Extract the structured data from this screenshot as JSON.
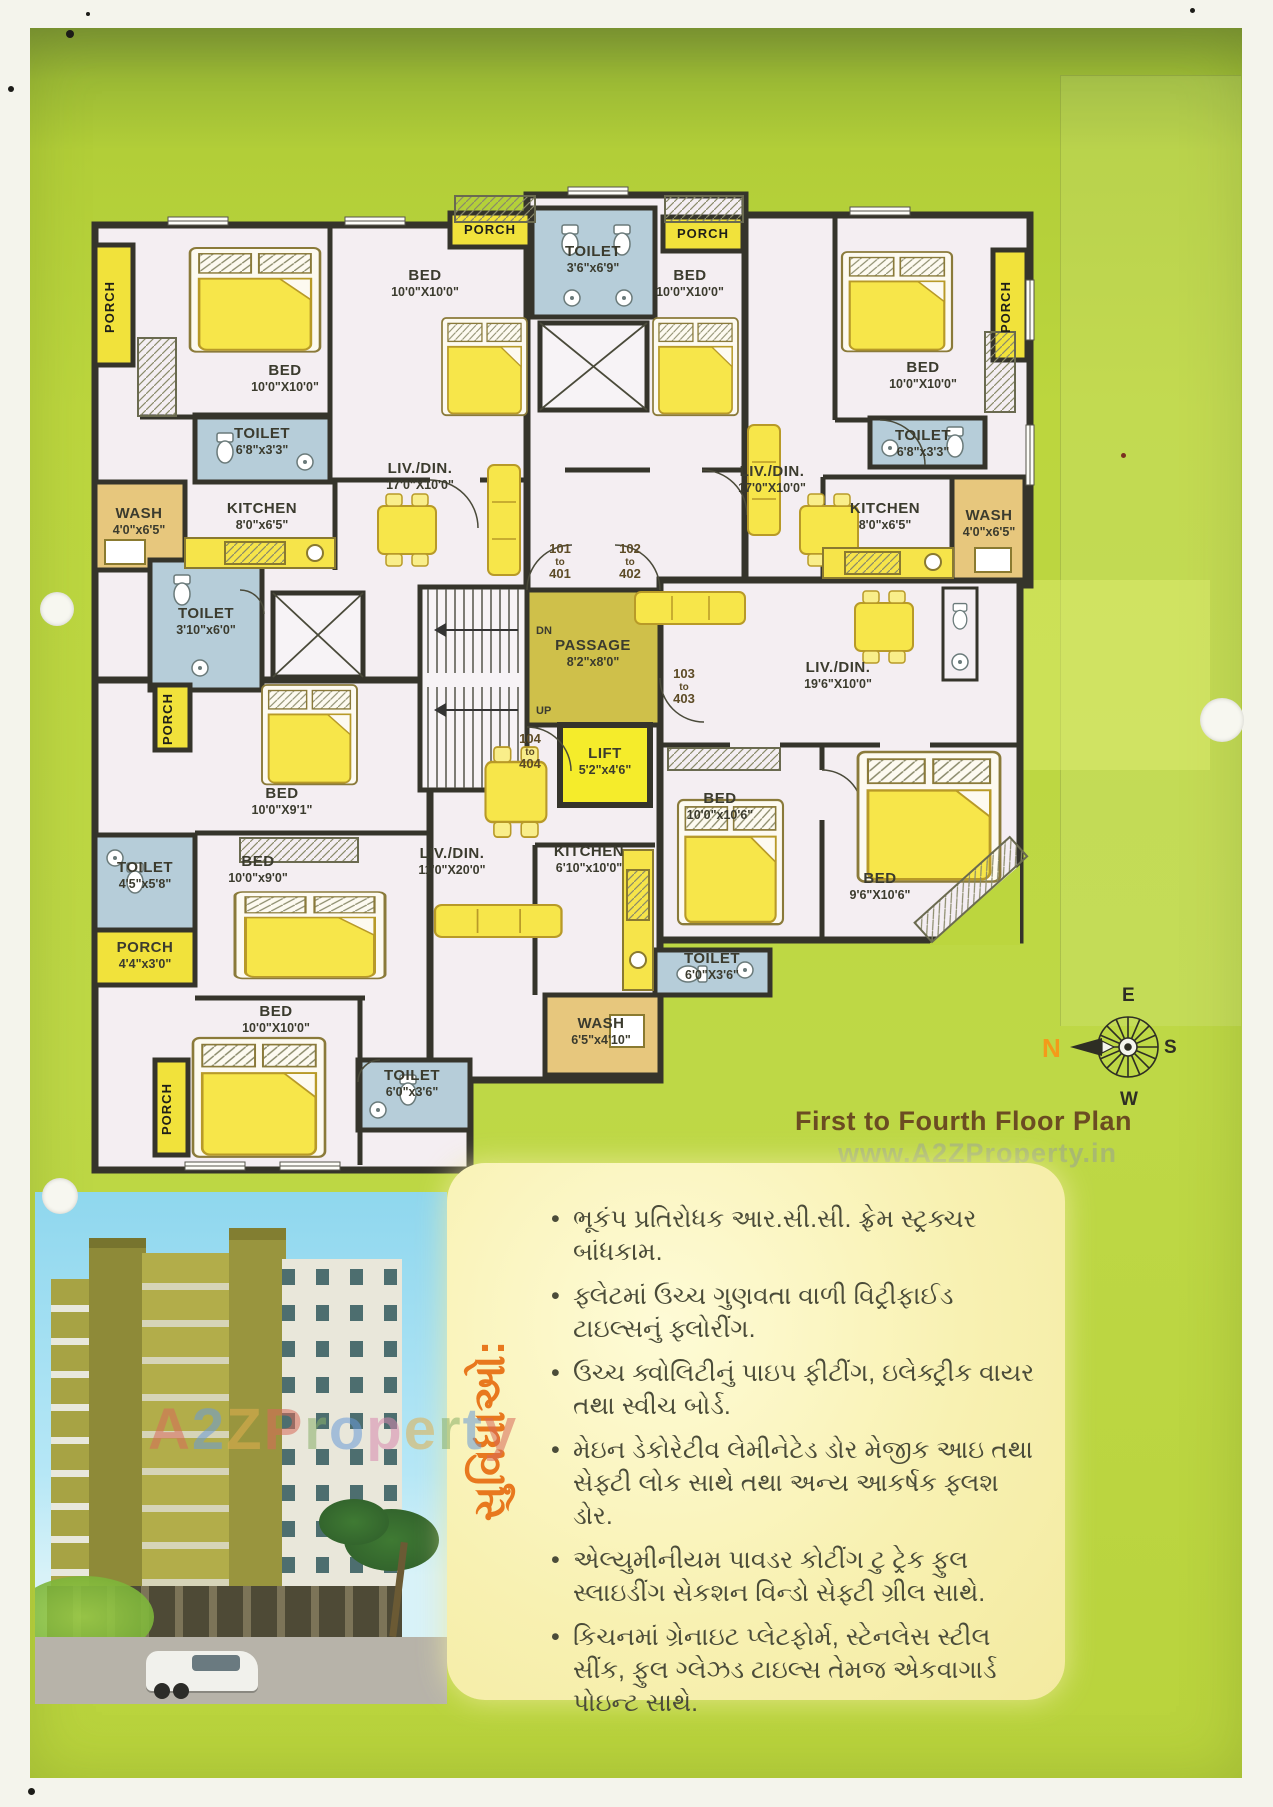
{
  "page": {
    "title": "First to Fourth Floor Plan",
    "watermark_small": "www.A2ZProperty.in",
    "watermark_large": "A2ZProperty",
    "watermark_colors": [
      "#d86a5a",
      "#6a9bd8",
      "#e0b050",
      "#d86a5a",
      "#8ab06a",
      "#6a9bd8",
      "#d88ab0",
      "#e0b050",
      "#8ab06a",
      "#6a9bd8",
      "#d86a5a"
    ]
  },
  "compass": {
    "n": "N",
    "e": "E",
    "s": "S",
    "w": "W"
  },
  "plan": {
    "porch_label": "PORCH",
    "rooms": [
      {
        "l": "BED",
        "d": "10'0\"X10'0\"",
        "x": 195,
        "y": 205
      },
      {
        "l": "TOILET",
        "d": "6'8\"x3'3\"",
        "x": 172,
        "y": 268
      },
      {
        "l": "WASH",
        "d": "4'0\"x6'5\"",
        "x": 49,
        "y": 348
      },
      {
        "l": "KITCHEN",
        "d": "8'0\"x6'5\"",
        "x": 172,
        "y": 343
      },
      {
        "l": "BED",
        "d": "10'0\"X10'0\"",
        "x": 335,
        "y": 110
      },
      {
        "l": "LIV./DIN.",
        "d": "17'0\"X10'0\"",
        "x": 330,
        "y": 303
      },
      {
        "l": "TOILET",
        "d": "3'6\"x6'9\"",
        "x": 503,
        "y": 86
      },
      {
        "l": "BED",
        "d": "10'0\"X10'0\"",
        "x": 600,
        "y": 110
      },
      {
        "l": "LIV./DIN.",
        "d": "17'0\"X10'0\"",
        "x": 682,
        "y": 306
      },
      {
        "l": "BED",
        "d": "10'0\"X10'0\"",
        "x": 833,
        "y": 202
      },
      {
        "l": "TOILET",
        "d": "6'8\"x3'3\"",
        "x": 833,
        "y": 270
      },
      {
        "l": "KITCHEN",
        "d": "8'0\"x6'5\"",
        "x": 795,
        "y": 343
      },
      {
        "l": "WASH",
        "d": "4'0\"x6'5\"",
        "x": 899,
        "y": 350
      },
      {
        "l": "TOILET",
        "d": "3'10\"x6'0\"",
        "x": 116,
        "y": 448
      },
      {
        "l": "PASSAGE",
        "d": "8'2\"x8'0\"",
        "x": 503,
        "y": 480
      },
      {
        "l": "LIFT",
        "d": "5'2\"x4'6\"",
        "x": 515,
        "y": 588
      },
      {
        "l": "LIV./DIN.",
        "d": "19'6\"X10'0\"",
        "x": 748,
        "y": 502
      },
      {
        "l": "BED",
        "d": "10'0\"X9'1\"",
        "x": 192,
        "y": 628
      },
      {
        "l": "TOILET",
        "d": "4'5\"x5'8\"",
        "x": 55,
        "y": 702
      },
      {
        "l": "BED",
        "d": "10'0\"x9'0\"",
        "x": 168,
        "y": 696
      },
      {
        "l": "PORCH",
        "d": "4'4\"x3'0\"",
        "x": 55,
        "y": 782
      },
      {
        "l": "BED",
        "d": "10'0\"X10'0\"",
        "x": 186,
        "y": 846
      },
      {
        "l": "TOILET",
        "d": "6'0\"x3'6\"",
        "x": 322,
        "y": 910
      },
      {
        "l": "LIV./DIN.",
        "d": "11'0\"X20'0\"",
        "x": 362,
        "y": 688
      },
      {
        "l": "KITCHEN",
        "d": "6'10\"x10'0\"",
        "x": 499,
        "y": 686
      },
      {
        "l": "WASH",
        "d": "6'5\"x4'10\"",
        "x": 511,
        "y": 858
      },
      {
        "l": "TOILET",
        "d": "6'0\"X3'6\"",
        "x": 622,
        "y": 793
      },
      {
        "l": "BED",
        "d": "10'0\"x10'6\"",
        "x": 630,
        "y": 633
      },
      {
        "l": "BED",
        "d": "9'6\"X10'6\"",
        "x": 790,
        "y": 713
      }
    ],
    "porches": [
      {
        "x": 24,
        "y": 137,
        "v": 1
      },
      {
        "x": 400,
        "y": 64,
        "v": 0
      },
      {
        "x": 613,
        "y": 68,
        "v": 0
      },
      {
        "x": 920,
        "y": 137,
        "v": 1
      },
      {
        "x": 82,
        "y": 549,
        "v": 1
      },
      {
        "x": 81,
        "y": 939,
        "v": 1
      }
    ],
    "doors": [
      {
        "a": "101",
        "b": "to",
        "c": "401",
        "x": 470,
        "y": 383
      },
      {
        "a": "102",
        "b": "to",
        "c": "402",
        "x": 540,
        "y": 383
      },
      {
        "a": "103",
        "b": "to",
        "c": "403",
        "x": 594,
        "y": 508
      },
      {
        "a": "104",
        "b": "to",
        "c": "404",
        "x": 440,
        "y": 573
      }
    ],
    "stairs": {
      "dn": "DN",
      "up": "UP"
    }
  },
  "facilities": {
    "heading": "સુવિધાઓ:",
    "items": [
      "ભૂકંપ પ્રતિરોધક આર.સી.સી. ફ્રેમ સ્ટ્રક્ચર બાંધકામ.",
      "ફ્લેટમાં ઉચ્ચ ગુણવતા વાળી વિટ્રીફાઈડ ટાઇલ્સનું ફ્લોરીંગ.",
      "ઉચ્ચ ક્વોલિટીનું પાઇપ ફીટીંગ, ઇલેક્ટ્રીક વાયર તથા સ્વીચ બોર્ડ.",
      "મેઇન ડેકોરેટીવ લેમીનેટેડ ડોર મેજીક આઇ તથા સેફ્ટી લોક સાથે તથા અન્ય આકર્ષક ફ્લશ ડોર.",
      "એલ્યુમીનીયમ પાવડર કોટીંગ ટુ ટ્રેક ફુલ સ્લાઇડીંગ સેકશન વિન્ડો સેફ્ટી ગ્રીલ સાથે.",
      "કિચનમાં ગ્રેનાઇટ પ્લેટફોર્મ, સ્ટેનલેસ સ્ટીલ સીંક, ફુલ ગ્લેઝડ ટાઇલ્સ તેમજ એકવાગાર્ડ પોઇન્ટ સાથે."
    ]
  }
}
